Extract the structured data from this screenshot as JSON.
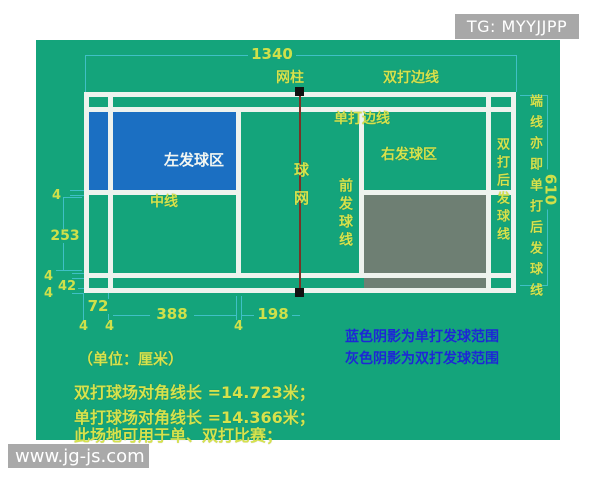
{
  "overlays": {
    "tg_badge": "TG: MYYJJPP",
    "site_watermark": "www.jg-js.com"
  },
  "court": {
    "labels": {
      "net_post": "网柱",
      "doubles_sideline": "双打边线",
      "singles_sideline": "单打边线",
      "left_service_area": "左发球区",
      "right_service_area": "右发球区",
      "center_line": "中线",
      "net": "球网",
      "front_service_line": "前发球线",
      "doubles_back_service_line": "双打后发球线",
      "end_line_note": "端线亦即单打后发球线"
    },
    "dimensions_cm": {
      "total_length": "1340",
      "total_width": "610",
      "half_court_width": "253",
      "back_alley_depth": "72",
      "service_depth": "388",
      "front_line_to_net": "198",
      "side_alley_width": "42",
      "line_width": "4"
    }
  },
  "notes": {
    "unit": "（单位：厘米）",
    "blue_shading": "蓝色阴影为单打发球范围",
    "gray_shading": "灰色阴影为双打发球范围",
    "doubles_diagonal": "双打球场对角线长 =14.723米；",
    "singles_diagonal": "单打球场对角线长 =14.366米；",
    "usage": "此场地可用于单、双打比赛；"
  },
  "colors": {
    "court_green": "#14a47b",
    "singles_service_blue": "#1b6fc2",
    "doubles_service_gray": "#6e7f73",
    "court_line_white": "#eef3ee",
    "label_yellow": "#d6e24c",
    "dimension_cyan": "#3fc0c6",
    "note_blue": "#1d27d6",
    "net_maroon": "#7a3226"
  }
}
